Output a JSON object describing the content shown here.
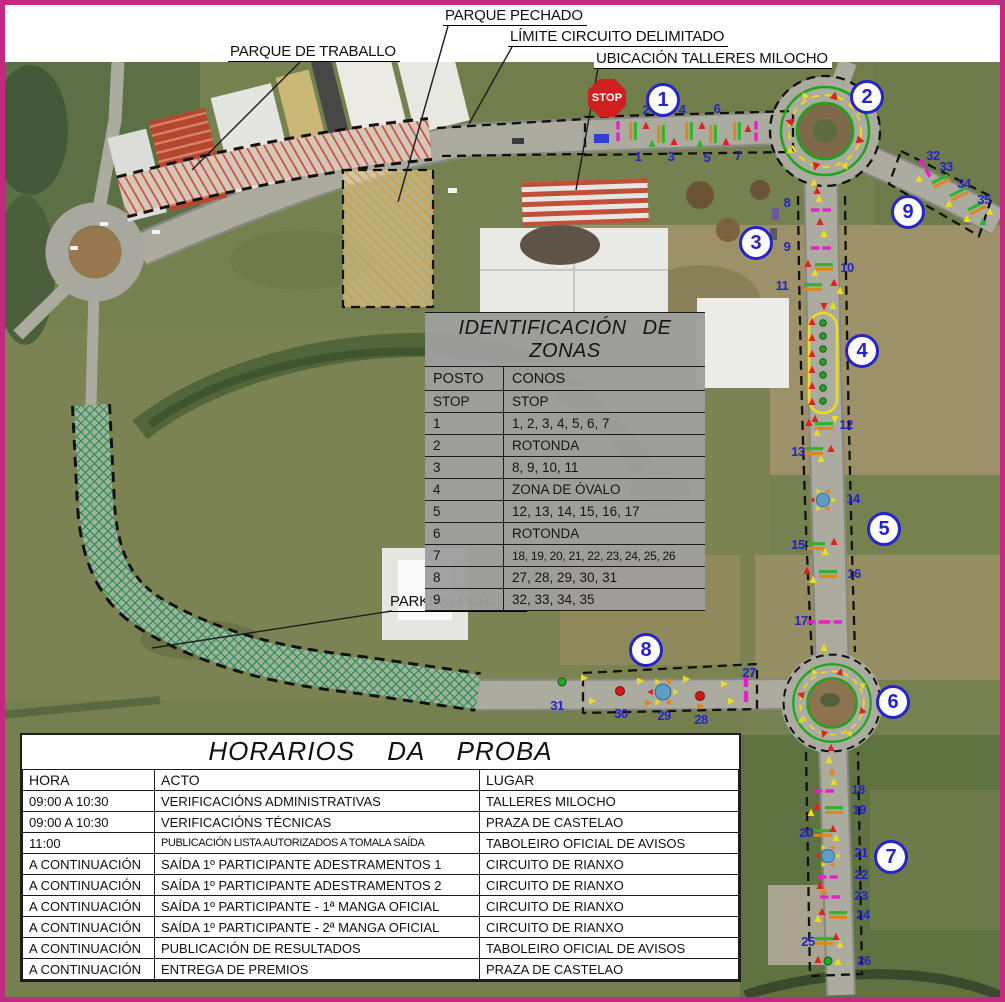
{
  "callouts": {
    "parque_pechado": "PARQUE PECHADO",
    "limite_circuito": "LÍMITE CIRCUITO DELIMITADO",
    "ubicacion_talleres": "UBICACIÓN TALLERES MILOCHO",
    "parque_traballo": "PARQUE DE TRABALLO",
    "parking_publico": "PARKING PÚBLICO"
  },
  "stop_sign": "STOP",
  "badges": [
    "1",
    "2",
    "3",
    "4",
    "5",
    "6",
    "7",
    "8",
    "9"
  ],
  "cones": [
    "1",
    "2",
    "3",
    "4",
    "5",
    "6",
    "7",
    "8",
    "9",
    "10",
    "11",
    "12",
    "13",
    "14",
    "15",
    "16",
    "17",
    "18",
    "19",
    "20",
    "21",
    "22",
    "23",
    "24",
    "25",
    "26",
    "27",
    "28",
    "29",
    "30",
    "31",
    "32",
    "33",
    "34",
    "35"
  ],
  "zones_table": {
    "title": "IDENTIFICACIÓN DE ZONAS",
    "headers": [
      "POSTO",
      "CONOS"
    ],
    "rows": [
      [
        "STOP",
        "STOP"
      ],
      [
        "1",
        "1, 2, 3, 4, 5, 6, 7"
      ],
      [
        "2",
        "ROTONDA"
      ],
      [
        "3",
        "8, 9, 10, 11"
      ],
      [
        "4",
        "ZONA DE ÓVALO"
      ],
      [
        "5",
        "12, 13, 14, 15, 16, 17"
      ],
      [
        "6",
        "ROTONDA"
      ],
      [
        "7",
        "18, 19, 20, 21, 22, 23, 24, 25, 26"
      ],
      [
        "8",
        "27, 28, 29, 30, 31"
      ],
      [
        "9",
        "32, 33, 34, 35"
      ]
    ]
  },
  "schedule_table": {
    "title": "HORARIOS DA PROBA",
    "headers": [
      "HORA",
      "ACTO",
      "LUGAR"
    ],
    "rows": [
      [
        "09:00 A 10:30",
        "VERIFICACIÓNS ADMINISTRATIVAS",
        "TALLERES MILOCHO"
      ],
      [
        "09:00 A 10:30",
        "VERIFICACIÓNS TÉCNICAS",
        "PRAZA DE CASTELAO"
      ],
      [
        "11:00",
        "PUBLICACIÓN LISTA AUTORIZADOS A TOMALA SAÍDA",
        "TABOLEIRO OFICIAL DE AVISOS"
      ],
      [
        "A CONTINUACIÓN",
        "SAÍDA 1º PARTICIPANTE ADESTRAMENTOS 1",
        "CIRCUITO DE RIANXO"
      ],
      [
        "A CONTINUACIÓN",
        "SAÍDA 1º PARTICIPANTE ADESTRAMENTOS 2",
        "CIRCUITO DE RIANXO"
      ],
      [
        "A CONTINUACIÓN",
        "SAÍDA 1º PARTICIPANTE - 1ª MANGA OFICIAL",
        "CIRCUITO DE RIANXO"
      ],
      [
        "A CONTINUACIÓN",
        "SAÍDA 1º PARTICIPANTE - 2ª MANGA OFICIAL",
        "CIRCUITO DE RIANXO"
      ],
      [
        "A CONTINUACIÓN",
        "PUBLICACIÓN DE RESULTADOS",
        "TABOLEIRO OFICIAL DE AVISOS"
      ],
      [
        "A CONTINUACIÓN",
        "ENTREGA DE PREMIOS",
        "PRAZA DE CASTELAO"
      ]
    ]
  },
  "colors": {
    "frame_magenta": "#c12a80",
    "badge_blue": "#2424c8",
    "cone_magenta": "#e81ec8",
    "cone_green": "#2cb52c",
    "cone_orange": "#e0861e",
    "cone_red": "#dd2020",
    "cone_yellow": "#eedc1c",
    "stop_red": "#d01f1f",
    "table_grey": "#9e9e9e"
  }
}
